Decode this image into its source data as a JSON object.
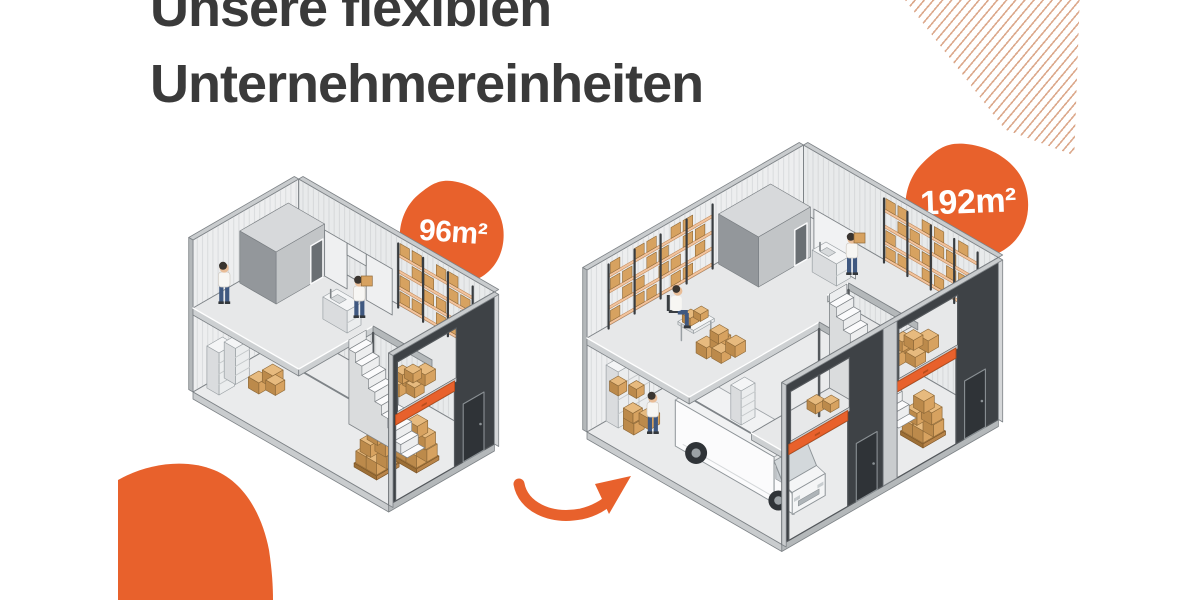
{
  "title": {
    "line1": "Unsere flexiblen",
    "line2": "Unternehmereinheiten"
  },
  "units": [
    {
      "id": "unit-96",
      "size_label": "96m²"
    },
    {
      "id": "unit-192",
      "size_label": "192m²"
    }
  ],
  "colors": {
    "accent": "#E8612C",
    "accent_dark": "#B84E1D",
    "title_text": "#3A3A3A",
    "badge_text": "#FFFFFF",
    "pattern_line": "#DCA98C",
    "wall": "#EDEEEF",
    "wall_stripe": "#DBDDDF",
    "wall2": "#E8EAEB",
    "wall2_stripe": "#D7D9DB",
    "outline": "#7E8387",
    "outline_dark": "#54585C",
    "cap": "#C9CCCE",
    "cap_dark": "#B4B8BA",
    "floor": "#EAEBEC",
    "slab": "#E7E8E9",
    "slab_edge": "#CDD0D2",
    "facade": "#3E4246",
    "facade_door": "#2F3337",
    "door_frame": "#8A9094",
    "box_top": "#E7BA7E",
    "box_side": "#D7A260",
    "box_dark": "#BC8A4B",
    "box_stroke": "#8F6A39",
    "shelf": "#F3C49E",
    "shelf_stroke": "#C08A5A",
    "post": "#383C40",
    "white": "#FBFBFC",
    "white_shade": "#E3E5E6",
    "room_top": "#D7D9DB",
    "room_right": "#C2C5C7",
    "room_left": "#93979B",
    "glass": "#D3D8DB",
    "skin": "#E9BD97",
    "hair": "#3A3530",
    "shirt": "#F7F6F3",
    "pants": "#3F5880",
    "shoe": "#33373B"
  }
}
